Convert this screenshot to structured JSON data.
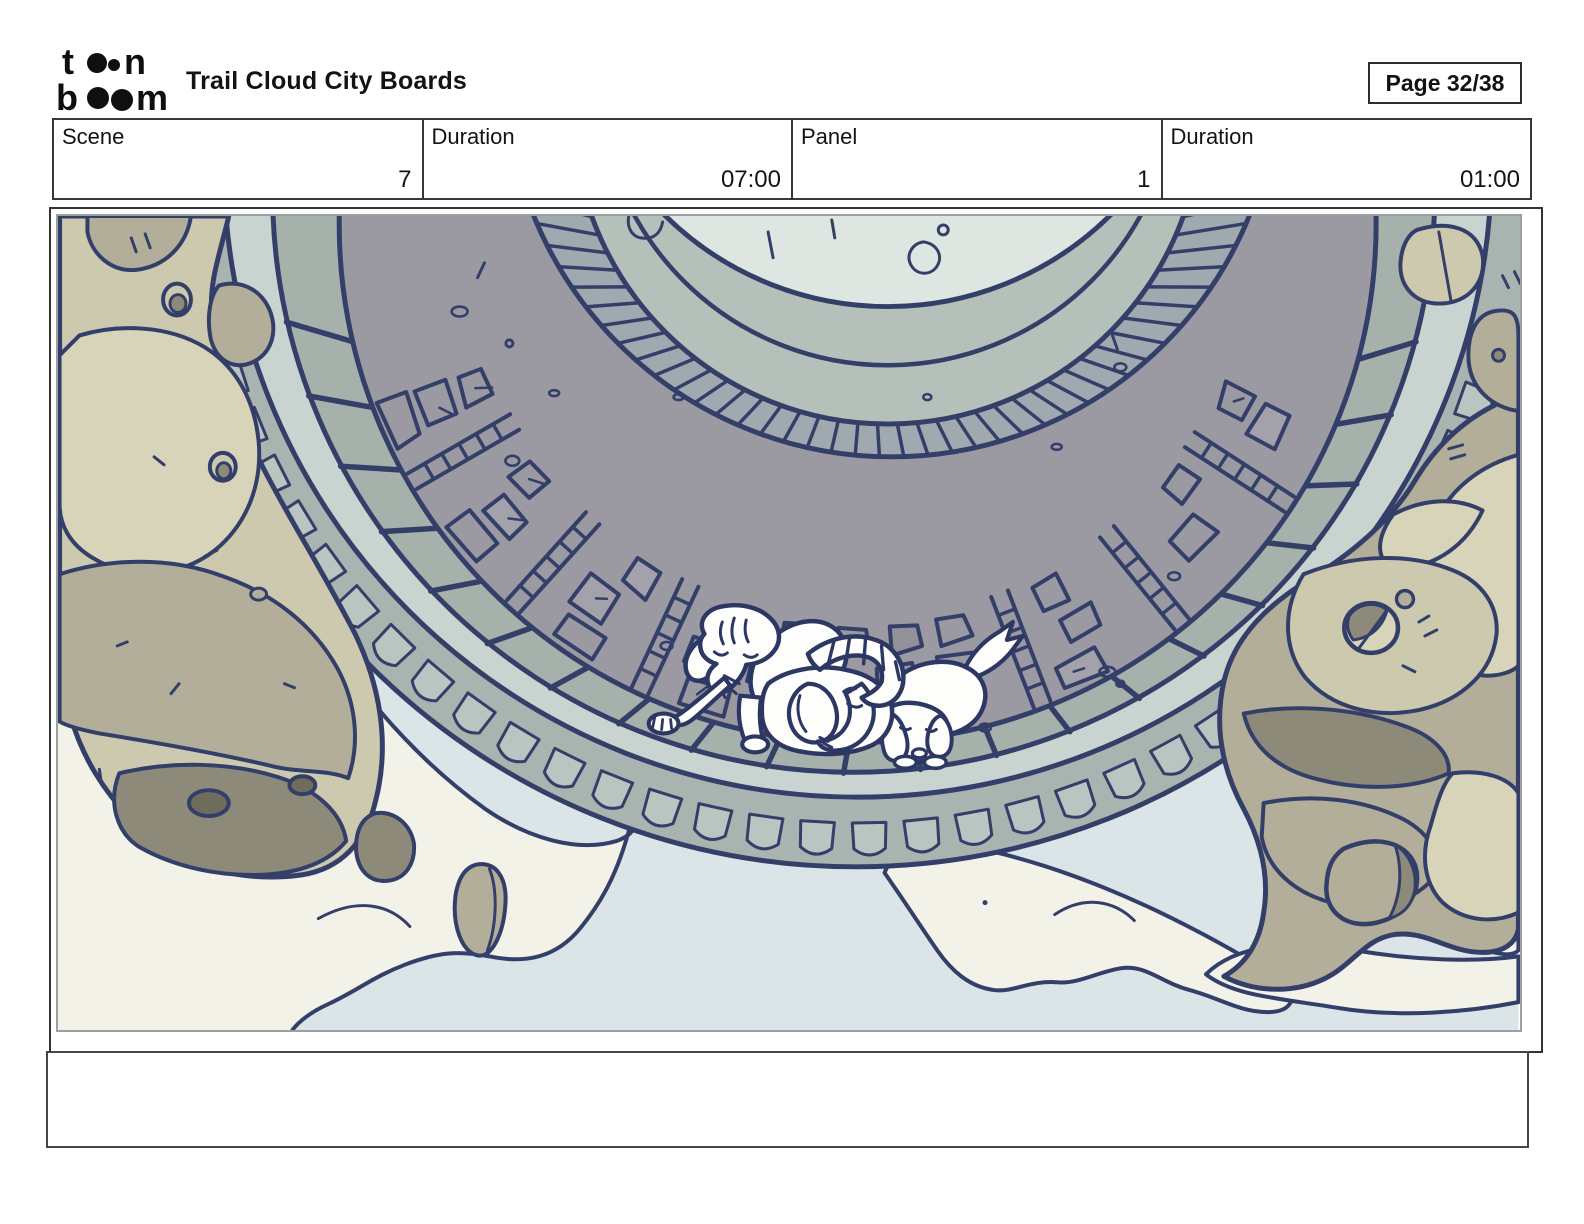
{
  "header": {
    "logo": {
      "l1a": "t",
      "l1b": "n",
      "l2a": "b",
      "l2b": "m"
    },
    "title": "Trail Cloud City Boards",
    "page_label": "Page 32/38"
  },
  "info_row": {
    "cells": [
      {
        "label": "Scene",
        "value": "7"
      },
      {
        "label": "Duration",
        "value": "07:00"
      },
      {
        "label": "Panel",
        "value": "1"
      },
      {
        "label": "Duration",
        "value": "01:00"
      }
    ]
  },
  "caption": {
    "text": ""
  },
  "artwork": {
    "subject": "three cartoon animals resting on the rim of a circular stone cloud-city platform surrounded by floating rocks and clouds",
    "palette": {
      "outline": "#333f69",
      "sky": "#dbe5e7",
      "cloud": "#f2f2e8",
      "disc_center": "#dde6e1",
      "disc_band": "#b6c0bb",
      "brick_ring": "#a0a9af",
      "cobblestone": "#9b9aa2",
      "stone_light": "#a3a2ab",
      "stone_dark": "#929199",
      "slab_band": "#a7b1ab",
      "walkway": "#c9d4d0",
      "rim": "#a9b3af",
      "rim_cell": "#bac4c0",
      "rock_light": "#cdc9af",
      "rock_lighter": "#d8d4ba",
      "rock_mid": "#b2ae9a",
      "rock_dark": "#8d8a79",
      "rock_hole": "#6f6c5c",
      "character_fill": "#fdfdfb",
      "character_outline": "#2c3763"
    }
  }
}
